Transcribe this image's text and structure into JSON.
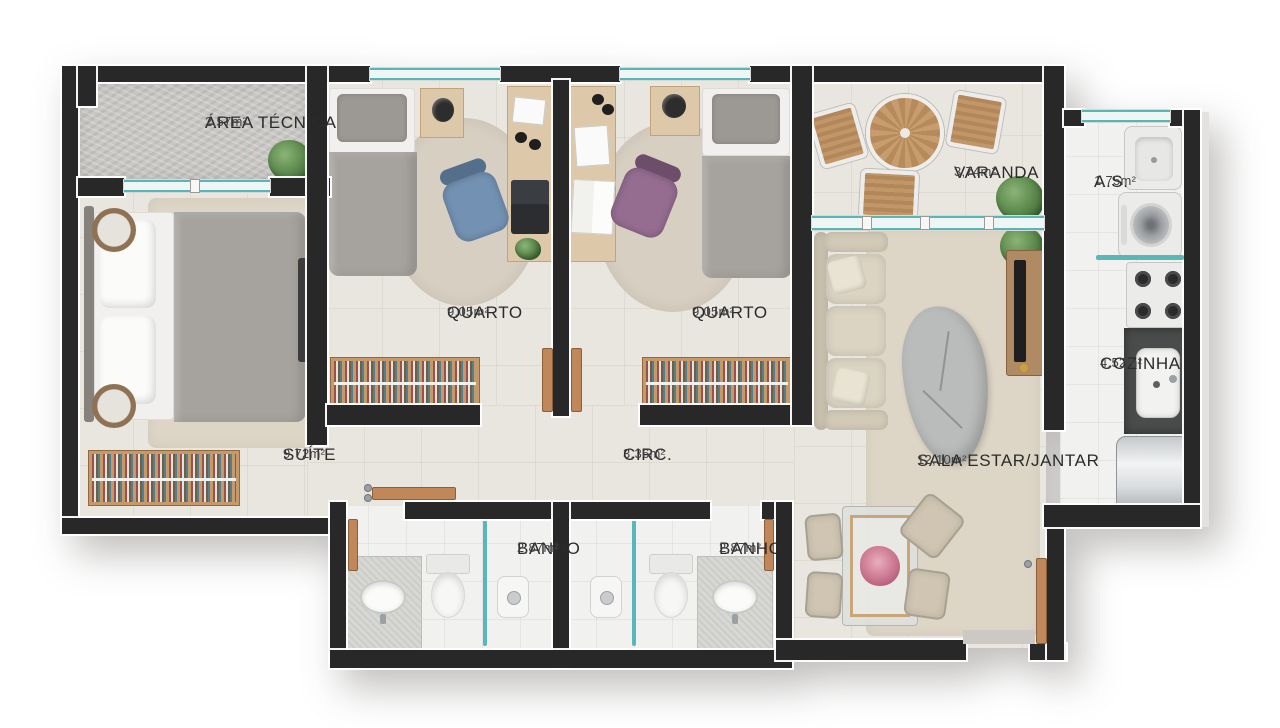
{
  "plan_title": "apartment-floor-plan",
  "rooms": [
    {
      "name": "ÁREA TÉCNICA",
      "area": "2,57m²"
    },
    {
      "name": "QUARTO",
      "area": "9,05m²"
    },
    {
      "name": "QUARTO",
      "area": "9,05m²"
    },
    {
      "name": "VARANDA",
      "area": "3,74m²"
    },
    {
      "name": "A.S.",
      "area": "1,75m²"
    },
    {
      "name": "COZINHA",
      "area": "4,52m²"
    },
    {
      "name": "SUÍTE",
      "area": "9,72m²"
    },
    {
      "name": "CIRC.",
      "area": "3,36m²"
    },
    {
      "name": "SALA ESTAR/JANTAR",
      "area": "12,10m²"
    },
    {
      "name": "BANHO",
      "area": "2,87m²"
    },
    {
      "name": "BANHO",
      "area": "2,87m²"
    }
  ],
  "colors": {
    "wall": "#282828",
    "window_frame": "#57b6b6",
    "door_wood": "#c0875a",
    "floor_warm": "#e9e6e0",
    "floor_wet": "#f1f1ef",
    "floor_concrete": "#c9c8c5",
    "label_text": "#2b2b2b"
  }
}
